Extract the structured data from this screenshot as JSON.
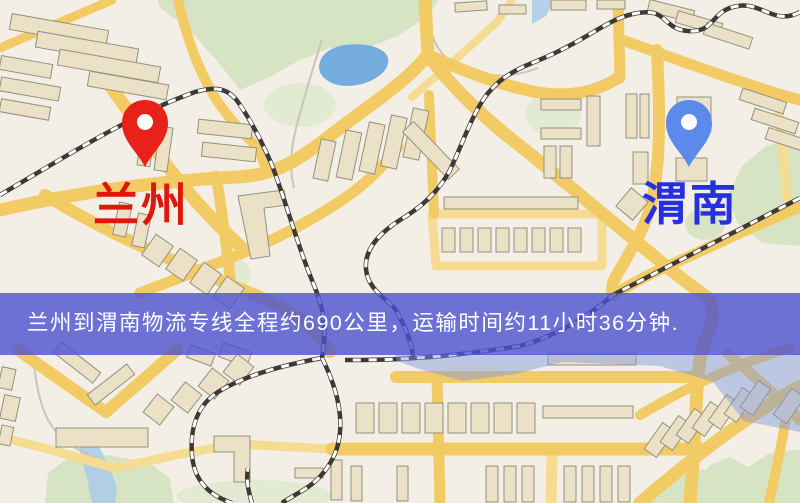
{
  "banner": {
    "text": "兰州到渭南物流专线全程约690公里，运输时间约11小时36分钟.",
    "bg_color": "#4B51D0",
    "text_color": "#FFFFFF"
  },
  "markers": {
    "origin": {
      "name": "兰州",
      "pin_color": "#E8211A",
      "label_color": "#E0170B"
    },
    "destination": {
      "name": "渭南",
      "pin_color": "#5B8AEC",
      "label_color": "#2531DF"
    }
  },
  "map": {
    "palette": {
      "bg": "#F4EFE6",
      "road_major": "#F2CB65",
      "road_minor": "#F6DC92",
      "building_fill": "#EBE1C6",
      "building_stroke": "#94917F",
      "green": "#D3E2C0",
      "green_pale": "#DEE9CE",
      "water": "#74ACDE",
      "water_light": "#A9CBE8",
      "rail_dark": "#3D3A36",
      "rail_light": "#FFFFFF",
      "path_gray": "#C9C5BB",
      "river_tint": "#7D96DC"
    },
    "greens": [
      {
        "type": "poly",
        "pts": "158,0 438,0 428,16 398,36 362,50 330,48 300,60 268,78 240,90 218,62 188,28 160,8",
        "fill": "green"
      },
      {
        "type": "ellipse",
        "cx": 300,
        "cy": 105,
        "rx": 36,
        "ry": 22,
        "fill": "green_pale"
      },
      {
        "type": "ellipse",
        "cx": 553,
        "cy": 114,
        "rx": 28,
        "ry": 22,
        "fill": "green_pale"
      },
      {
        "type": "poly",
        "pts": "800,136 800,246 762,243 737,222 728,196 742,166 766,146",
        "fill": "green"
      },
      {
        "type": "ellipse",
        "cx": 705,
        "cy": 224,
        "rx": 20,
        "ry": 16,
        "fill": "green"
      },
      {
        "type": "ellipse",
        "cx": 237,
        "cy": 274,
        "rx": 14,
        "ry": 15,
        "fill": "green_pale"
      },
      {
        "type": "poly",
        "pts": "640,503 660,480 690,468 705,470 712,464 730,457 748,467 768,454 800,449 800,503",
        "fill": "green"
      },
      {
        "type": "poly",
        "pts": "45,503 48,473 68,458 108,455 148,462 170,478 174,503",
        "fill": "green"
      },
      {
        "type": "ellipse",
        "cx": 255,
        "cy": 496,
        "rx": 78,
        "ry": 16,
        "fill": "green_pale"
      }
    ],
    "waters": [
      {
        "type": "path",
        "d": "M320,62 C324,48 344,42 366,45 C386,48 393,58 385,70 C374,84 348,90 332,83 C321,78 317,70 320,62 Z",
        "fill": "water"
      },
      {
        "type": "poly",
        "pts": "88,434 100,448 110,468 117,488 115,503 92,503 87,478 81,458 79,444",
        "fill": "water_light"
      },
      {
        "type": "poly",
        "pts": "532,0 554,0 546,16 532,24",
        "fill": "water_light"
      }
    ],
    "paths_gray": [
      "M322,40 C312,70 305,95 297,124 C291,148 289,168 294,188",
      "M32,352 C36,380 38,400 48,420 C58,438 76,450 96,458",
      "M428,16 C431,40 440,60 466,70 C494,80 520,75 538,68"
    ],
    "roads_minor": [
      {
        "d": "M432,214 L602,214 L602,266 L436,266 Z",
        "w": 9
      },
      {
        "d": "M0,437 L40,447 L115,468 L176,455 L236,444 L332,449",
        "w": 9
      },
      {
        "d": "M779,112 L787,198",
        "w": 9
      },
      {
        "d": "M552,455 L551,503",
        "w": 11
      },
      {
        "d": "M412,97 L455,60 L497,22 L512,0",
        "w": 8
      }
    ],
    "roads_major": [
      {
        "d": "M0,210 C90,190 170,180 238,177 C276,175 299,160 331,135 C366,107 401,87 428,55",
        "w": 13
      },
      {
        "d": "M425,0 L428,55",
        "w": 13
      },
      {
        "d": "M0,48 L112,0",
        "w": 9
      },
      {
        "d": "M178,0 C186,34 196,66 214,96 C224,112 236,126 250,140 C258,148 263,158 266,170",
        "w": 10
      },
      {
        "d": "M88,55 C112,88 136,122 160,156 C184,190 214,222 242,248",
        "w": 13
      },
      {
        "d": "M428,55 C450,85 478,112 510,138 C546,166 580,195 620,228 C656,258 680,278 704,295 C716,304 714,320 706,338 C700,352 698,370 697,390 L694,445 L690,503",
        "w": 13
      },
      {
        "d": "M45,195 C118,240 190,268 258,296 C296,312 318,330 330,352",
        "w": 12
      },
      {
        "d": "M140,293 L233,257 C278,239 320,216 352,193 C372,178 386,163 398,147",
        "w": 11
      },
      {
        "d": "M216,176 C222,210 227,250 232,294",
        "w": 11
      },
      {
        "d": "M429,95 L434,214",
        "w": 10
      },
      {
        "d": "M428,55 C470,74 502,85 535,92 C568,98 596,92 618,78",
        "w": 12
      },
      {
        "d": "M618,0 L620,78",
        "w": 11
      },
      {
        "d": "M622,40 C665,55 705,70 745,83 C765,90 785,96 800,100",
        "w": 11
      },
      {
        "d": "M657,50 C660,110 661,165 651,205 C644,230 630,252 615,278 C611,286 612,292 613,295",
        "w": 12
      },
      {
        "d": "M800,207 C750,227 700,252 655,272 C640,279 625,288 613,295",
        "w": 11
      },
      {
        "d": "M332,449 L706,449",
        "w": 13
      },
      {
        "d": "M396,377 L700,377",
        "w": 12
      },
      {
        "d": "M437,377 L440,503",
        "w": 11
      },
      {
        "d": "M18,350 L106,412 L177,350",
        "w": 12
      },
      {
        "d": "M728,354 C750,372 776,396 800,420",
        "w": 11
      },
      {
        "d": "M640,503 C662,484 688,462 718,440 C748,418 775,400 800,386",
        "w": 13
      },
      {
        "d": "M640,415 C690,385 740,363 790,348",
        "w": 10
      },
      {
        "d": "M786,418 C781,448 775,475 769,503",
        "w": 10
      }
    ],
    "railways": [
      "M0,195 C60,160 130,115 195,92 C215,86 228,88 238,102 C252,122 262,142 272,165 C285,200 295,235 305,262 C312,282 318,292 322,310 C326,330 324,345 322,358 C300,362 250,372 218,392 C196,406 190,430 192,455 C194,480 208,495 232,503",
      "M322,358 C334,382 342,408 340,432 C338,458 322,480 300,492 C292,497 286,500 282,503",
      "M252,503 C248,490 246,480 248,468",
      "M800,12 C775,26 762,2 738,6 C710,10 716,33 688,31 C662,29 668,8 638,13 C606,18 590,40 532,63 C510,72 495,82 483,100 C470,120 462,145 450,170 C438,193 420,208 400,220 C375,236 360,255 368,278 C374,293 388,300 396,310 C406,328 412,345 413,357",
      "M800,198 L613,295 C590,315 560,335 520,346",
      "M520,346 C480,352 450,356 415,358 C390,360 365,360 345,360"
    ],
    "buildings": [
      [
        10,
        22,
        98,
        16,
        10
      ],
      [
        36,
        40,
        102,
        16,
        10
      ],
      [
        58,
        58,
        102,
        16,
        10
      ],
      [
        88,
        78,
        80,
        15,
        10
      ],
      [
        0,
        60,
        52,
        14,
        10
      ],
      [
        0,
        82,
        60,
        14,
        10
      ],
      [
        0,
        103,
        50,
        13,
        10
      ],
      [
        140,
        122,
        13,
        44,
        8
      ],
      [
        157,
        127,
        13,
        44,
        8
      ],
      [
        198,
        122,
        54,
        14,
        6
      ],
      [
        202,
        145,
        54,
        14,
        6
      ],
      [
        116,
        203,
        13,
        33,
        12
      ],
      [
        135,
        214,
        13,
        33,
        12
      ],
      [
        147,
        238,
        21,
        25,
        35
      ],
      [
        171,
        252,
        21,
        25,
        35
      ],
      [
        195,
        266,
        21,
        25,
        35
      ],
      [
        218,
        280,
        21,
        25,
        35
      ],
      [
        317,
        140,
        15,
        40,
        12
      ],
      [
        341,
        131,
        16,
        48,
        12
      ],
      [
        364,
        123,
        16,
        50,
        12
      ],
      [
        386,
        116,
        16,
        52,
        12
      ],
      [
        408,
        109,
        16,
        50,
        12
      ],
      [
        398,
        143,
        66,
        15,
        46
      ],
      [
        455,
        2,
        32,
        9,
        -4
      ],
      [
        499,
        5,
        27,
        9,
        0
      ],
      [
        551,
        0,
        35,
        10,
        0
      ],
      [
        597,
        0,
        28,
        9,
        0
      ],
      [
        648,
        5,
        46,
        12,
        14
      ],
      [
        676,
        17,
        46,
        12,
        16
      ],
      [
        704,
        30,
        48,
        12,
        18
      ],
      [
        740,
        95,
        46,
        12,
        18
      ],
      [
        752,
        115,
        46,
        12,
        18
      ],
      [
        766,
        134,
        44,
        12,
        18
      ],
      [
        541,
        99,
        40,
        11,
        0
      ],
      [
        541,
        128,
        40,
        11,
        0
      ],
      [
        544,
        146,
        12,
        32,
        0
      ],
      [
        560,
        146,
        12,
        32,
        0
      ],
      [
        587,
        96,
        13,
        50,
        0
      ],
      [
        626,
        94,
        11,
        44,
        0
      ],
      [
        640,
        94,
        9,
        44,
        0
      ],
      [
        677,
        97,
        34,
        34,
        0
      ],
      [
        676,
        158,
        31,
        23,
        0
      ],
      [
        633,
        152,
        15,
        32,
        0
      ],
      [
        621,
        192,
        22,
        24,
        40
      ],
      [
        442,
        228,
        13,
        24,
        0
      ],
      [
        460,
        228,
        13,
        24,
        0
      ],
      [
        478,
        228,
        13,
        24,
        0
      ],
      [
        496,
        228,
        13,
        24,
        0
      ],
      [
        514,
        228,
        13,
        24,
        0
      ],
      [
        532,
        228,
        13,
        24,
        0
      ],
      [
        550,
        228,
        13,
        24,
        0
      ],
      [
        568,
        228,
        13,
        24,
        0
      ],
      [
        444,
        197,
        134,
        12,
        0
      ],
      [
        52,
        356,
        50,
        13,
        38
      ],
      [
        86,
        378,
        50,
        13,
        -38
      ],
      [
        188,
        349,
        26,
        13,
        20
      ],
      [
        220,
        347,
        30,
        15,
        20
      ],
      [
        148,
        398,
        21,
        23,
        38
      ],
      [
        176,
        386,
        21,
        23,
        38
      ],
      [
        203,
        372,
        21,
        23,
        38
      ],
      [
        228,
        358,
        21,
        23,
        38
      ],
      [
        56,
        428,
        92,
        19,
        0
      ],
      [
        0,
        368,
        14,
        21,
        12
      ],
      [
        2,
        396,
        16,
        24,
        12
      ],
      [
        0,
        426,
        12,
        19,
        12
      ],
      [
        331,
        460,
        11,
        40,
        0
      ],
      [
        351,
        466,
        11,
        35,
        0
      ],
      [
        397,
        466,
        11,
        35,
        0
      ],
      [
        295,
        468,
        28,
        10,
        0
      ],
      [
        356,
        403,
        18,
        30,
        0
      ],
      [
        379,
        403,
        18,
        30,
        0
      ],
      [
        402,
        403,
        18,
        30,
        0
      ],
      [
        425,
        403,
        18,
        30,
        0
      ],
      [
        448,
        403,
        18,
        30,
        0
      ],
      [
        471,
        403,
        18,
        30,
        0
      ],
      [
        494,
        403,
        18,
        30,
        0
      ],
      [
        517,
        403,
        18,
        30,
        0
      ],
      [
        543,
        406,
        90,
        12,
        0
      ],
      [
        548,
        354,
        88,
        11,
        0
      ],
      [
        486,
        466,
        12,
        36,
        0
      ],
      [
        504,
        466,
        12,
        36,
        0
      ],
      [
        522,
        466,
        12,
        36,
        0
      ],
      [
        564,
        466,
        12,
        36,
        0
      ],
      [
        582,
        466,
        12,
        36,
        0
      ],
      [
        600,
        466,
        12,
        36,
        0
      ],
      [
        618,
        466,
        12,
        36,
        0
      ],
      [
        652,
        424,
        15,
        32,
        35
      ],
      [
        668,
        417,
        15,
        32,
        35
      ],
      [
        684,
        410,
        15,
        32,
        35
      ],
      [
        700,
        403,
        15,
        32,
        35
      ],
      [
        716,
        396,
        15,
        32,
        35
      ],
      [
        732,
        389,
        15,
        32,
        35
      ],
      [
        748,
        382,
        15,
        32,
        35
      ],
      [
        781,
        390,
        16,
        32,
        35
      ]
    ],
    "building_polys": [
      "238,196 284,190 287,205 264,208 270,256 251,259",
      "214,436 250,436 250,482 234,482 234,452 214,452"
    ],
    "river_tint_pts": "395,354 800,354 800,432 744,421 713,382 660,366 562,362 516,374 463,381 419,369 397,361"
  }
}
